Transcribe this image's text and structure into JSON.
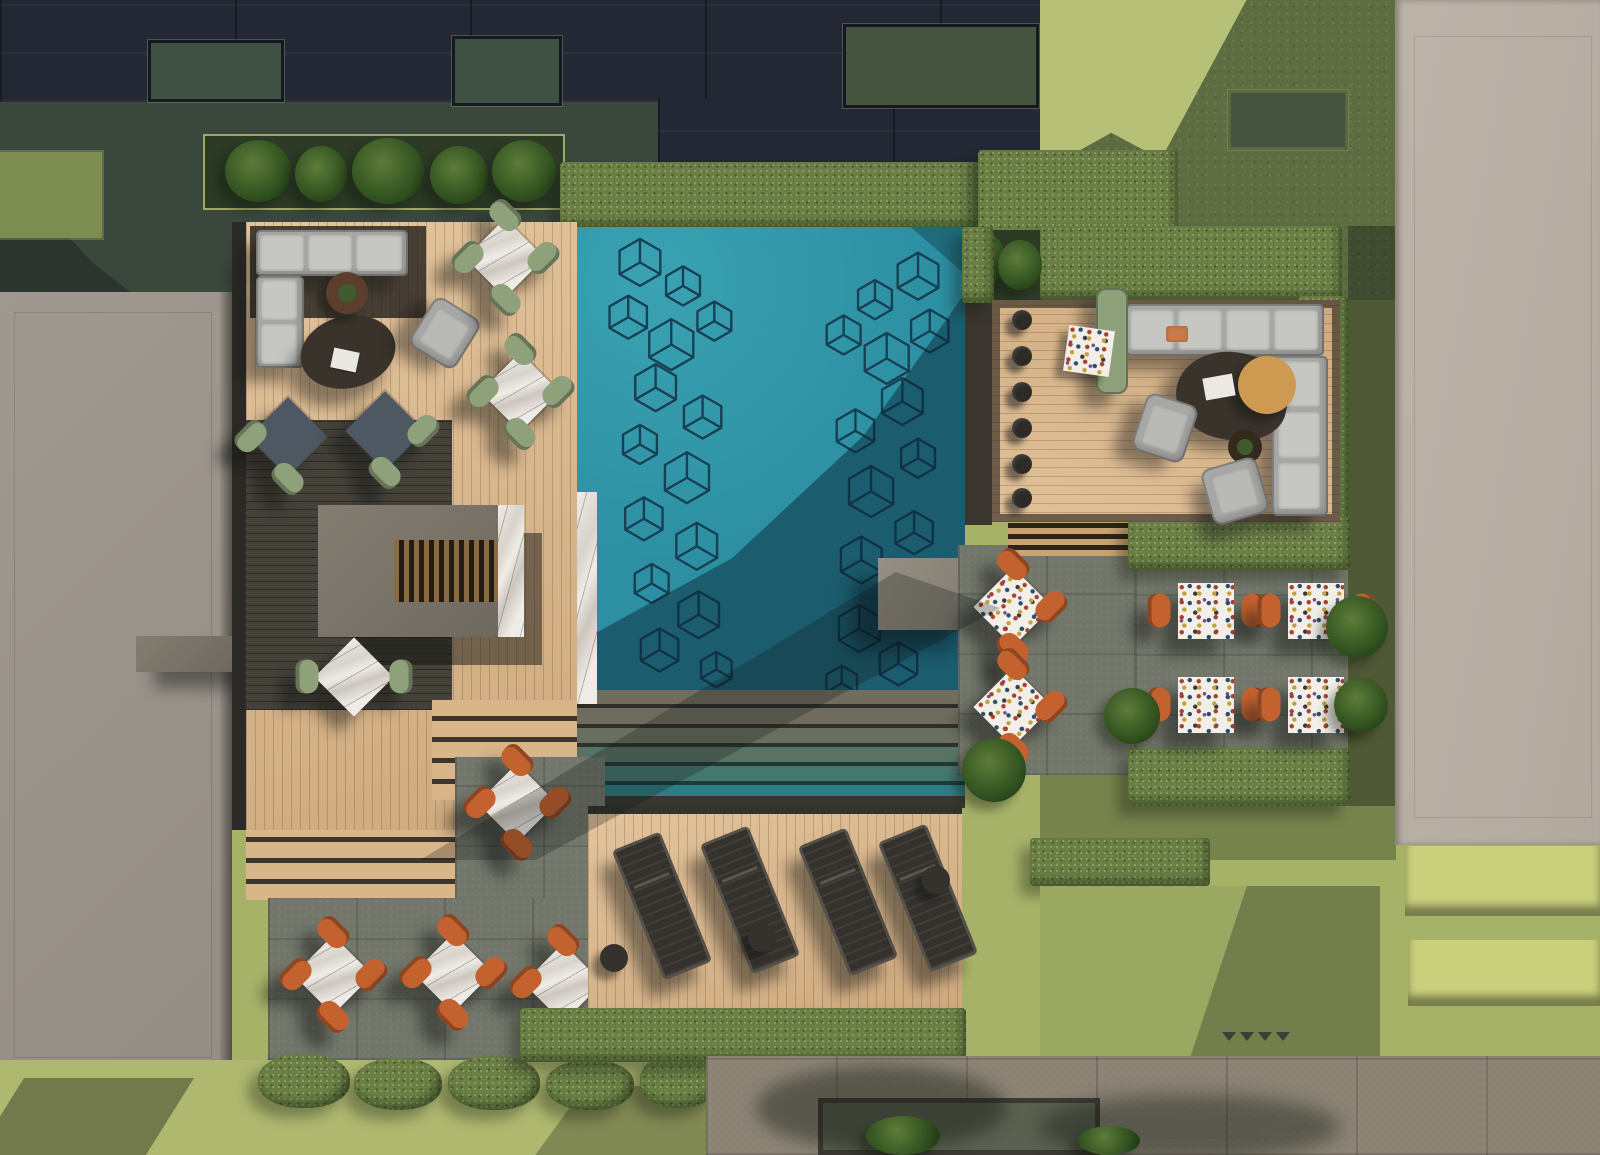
{
  "scene": {
    "title": "Rooftop pool terrace — aerial architectural rendering",
    "view": "top-down 3D visualization, hard sunlight with long cast shadows",
    "setting": "residential courtyard amenity deck between buildings"
  },
  "palette": {
    "pool": "#2C8FA2",
    "pool_light": "#3AA2B2",
    "pool_shadow": "#0E3C52",
    "cube_line": "#16384D",
    "wood_light": "#D9B58A",
    "wood_dark": "#45423A",
    "stone": "#73766A",
    "pavement": "#8B8374",
    "hedge": "#6B7F45",
    "lawn": "#A7B269",
    "lawn_shadow": "#5D6C41",
    "terrace_green": "#3A473C",
    "building_dark": "#232834",
    "building_beige": "#B8AFA5",
    "roof_gray": "#9B948C",
    "concrete": "#7B756B",
    "sofa": "#A7A7A5",
    "chair_green": "#8FA17B",
    "chair_orange": "#C4622F",
    "marble": "#EDEAE4",
    "terrazzo": "#F2EFE9",
    "lounger": "#35322D",
    "timber_round_table": "#CE9A52",
    "skylight_panel": "#C9CF7B"
  },
  "labels": {
    "pool": "Rectangular swimming pool with isometric cube mural on the floor",
    "pool_steps": "Full-width shallow entry steps at the south end of the pool",
    "swim_up_counter": "Marble swim-up bar ledge with six stools on the west pool edge",
    "left_lounge": "West timber deck lounge with L-shaped grey sectional, armchair, oval coffee table and planter bowl",
    "right_lounge": "East timber deck lounge with L-shaped grey sectional, organic coffee table, round timber side table, chaise and two armchairs",
    "outdoor_bar": "Concrete outdoor kitchen / bar block with timber slat pergola",
    "green_dining": "Cafe sets with sage-green barrel chairs and white marble tables on the west deck",
    "orange_dining": "Bistro tables with cognac leather chairs and white terrazzo or marble tops on stone patios",
    "sun_deck": "South timber sun deck with four dark loungers and round side tables",
    "dark_building": "Dark charcoal residential block along the north edge with recessed green patios",
    "beige_building": "Beige residential block along the east edge",
    "left_roof": "Plain warm-grey roof slab on the west edge",
    "lawns": "Olive green lawns and clipped hedges framing the terraces",
    "pavement": "Stone paving band along the south edge with tree shadows"
  },
  "inventory": {
    "pools": "1 rectangular pool, teal water, two columns of line-drawn isometric cubes on the floor",
    "green_chair_sets": "5 dining sets with sage-green chairs (two 4-seat sets, two slate-top sets, one 2-seat set)",
    "orange_chair_sets": "10 bistro sets with cognac-orange chairs (3 on the south-west patio, 3 by the pool's east stone patio, 4 in the east hedge alcoves)",
    "sun_loungers": "4 dark sun loungers with 3 round side tables",
    "bar_stools": "6 swim-up stools on the west edge, 6 deck stools on the east edge, 4 south counter stools",
    "sofas": "2 L-shaped light-grey sectionals",
    "armchairs": "3 grey armchairs and 1 sage chaise longue",
    "coffee_tables": "1 dark oval table (west), 1 dark organic table with round timber side table (east)"
  }
}
